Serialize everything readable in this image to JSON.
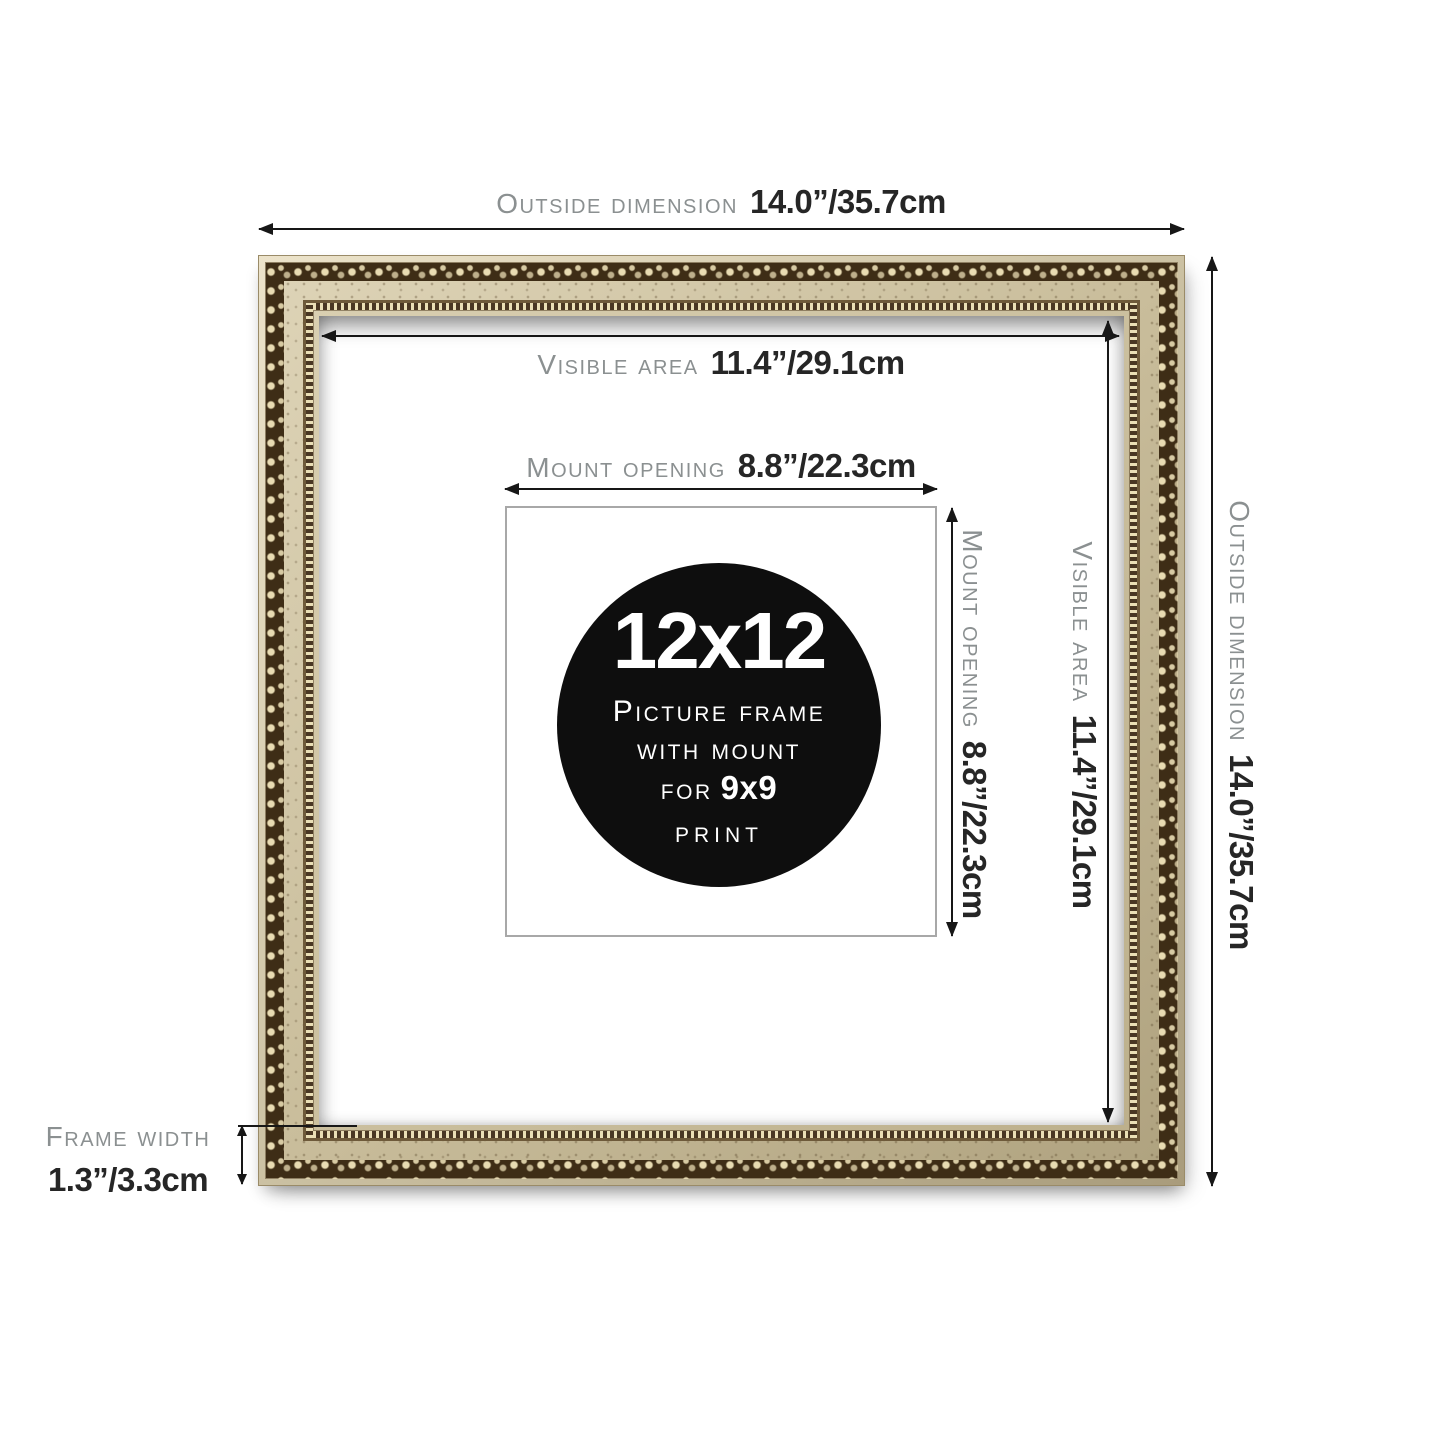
{
  "labels": {
    "outside_top": {
      "name": "Outside dimension",
      "value": "14.0”/35.7cm"
    },
    "visible_top": {
      "name": "Visible area",
      "value": "11.4”/29.1cm"
    },
    "mount_top": {
      "name": "Mount opening",
      "value": "8.8”/22.3cm"
    },
    "mount_right": {
      "name": "Mount opening",
      "value": "8.8”/22.3cm"
    },
    "visible_right": {
      "name": "Visible area",
      "value": "11.4”/29.1cm"
    },
    "outside_right": {
      "name": "Outside dimension",
      "value": "14.0”/35.7cm"
    },
    "frame_width": {
      "name": "Frame width",
      "value": "1.3”/3.3cm"
    }
  },
  "badge": {
    "size": "12x12",
    "line1": "Picture frame",
    "line2": "with mount",
    "for_label": "for",
    "print_size": "9x9",
    "print_label": "print"
  },
  "colors": {
    "label_gray": "#8b9091",
    "label_dark": "#262626",
    "arrow": "#171717",
    "frame_champagne": "#c9bd9b",
    "frame_scroll_dark": "#3e2d16",
    "frame_scroll_cream": "#e8dbb2",
    "badge_bg": "#0e0e0e",
    "badge_text": "#ffffff",
    "mount_border": "#a8a8a8",
    "mat": "#ffffff"
  }
}
